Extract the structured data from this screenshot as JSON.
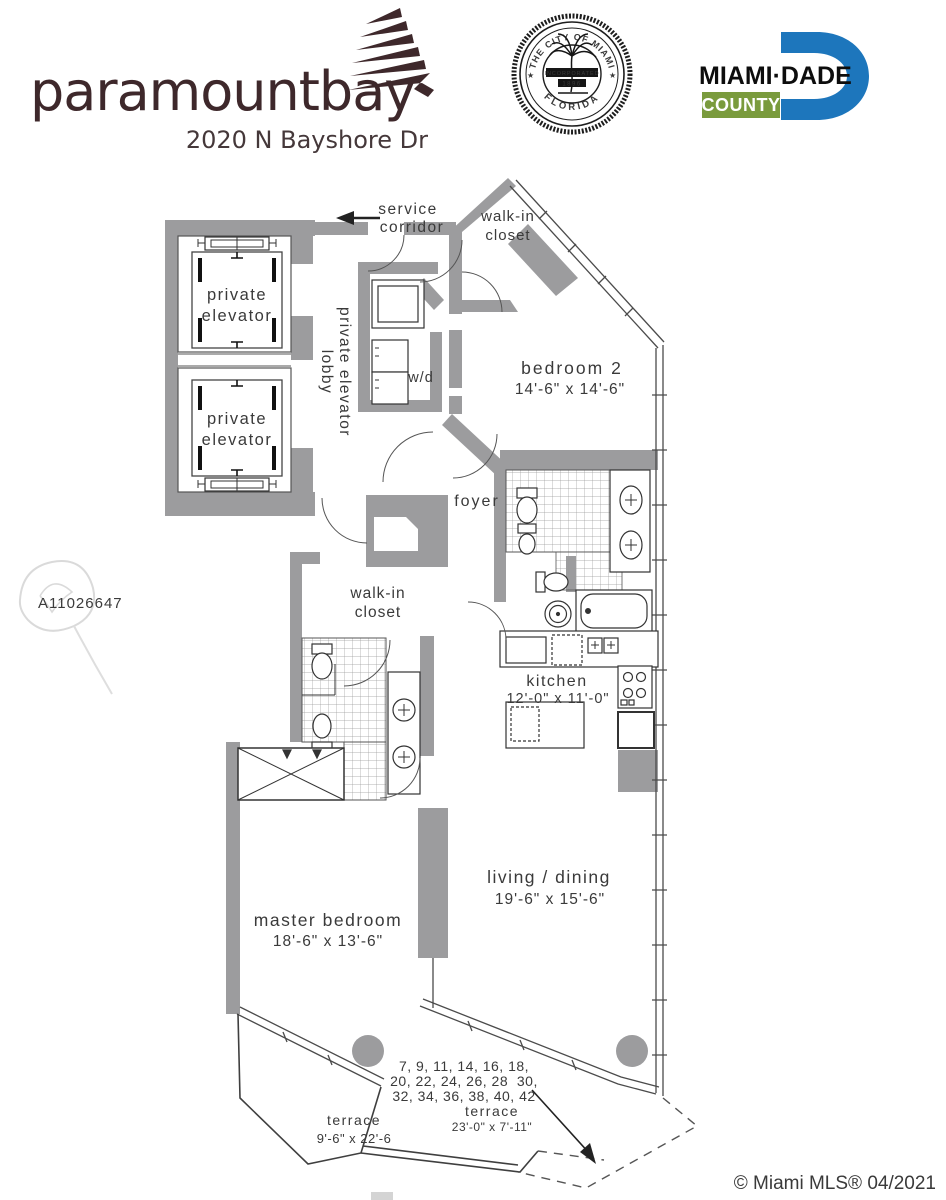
{
  "header": {
    "brand_name": "paramountbay",
    "brand_address": "2020 N Bayshore Dr",
    "seal": {
      "top": "THE CITY OF MIAMI",
      "bottom": "FLORIDA",
      "inc": "INCORPORATED",
      "year": "1896"
    },
    "county": {
      "name": "MIAMI·DADE",
      "sub": "COUNTY"
    }
  },
  "plan": {
    "service_corridor": {
      "l1": "service",
      "l2": "corridor"
    },
    "walkin_closet_b2": {
      "l1": "walk-in",
      "l2": "closet"
    },
    "elevator_top": {
      "l1": "private",
      "l2": "elevator"
    },
    "elevator_bottom": {
      "l1": "private",
      "l2": "elevator"
    },
    "lobby": {
      "l1": "private elevator",
      "l2": "lobby"
    },
    "wd": "w/d",
    "foyer": "foyer",
    "bedroom2": {
      "name": "bedroom 2",
      "dims": "14'-6\" x 14'-6\""
    },
    "kitchen": {
      "name": "kitchen",
      "dims": "12'-0\" x 11'-0\""
    },
    "walkin_closet_master": {
      "l1": "walk-in",
      "l2": "closet"
    },
    "living": {
      "name": "living / dining",
      "dims": "19'-6\" x 15'-6\""
    },
    "master": {
      "name": "master bedroom",
      "dims": "18'-6\" x 13'-6\""
    },
    "terrace_left": {
      "name": "terrace",
      "dims": "9'-6\" x 22'-6"
    },
    "terrace_main": {
      "name": "terrace",
      "dims": "23'-0\" x 7'-11\""
    },
    "floors": {
      "l1": "7, 9, 11, 14, 16, 18,",
      "l2": "20, 22, 24, 26, 28  30,",
      "l3": "32, 34, 36, 38, 40, 42"
    }
  },
  "watermark": {
    "mls_id": "A11026647",
    "copyright": "© Miami MLS® 04/2021"
  }
}
